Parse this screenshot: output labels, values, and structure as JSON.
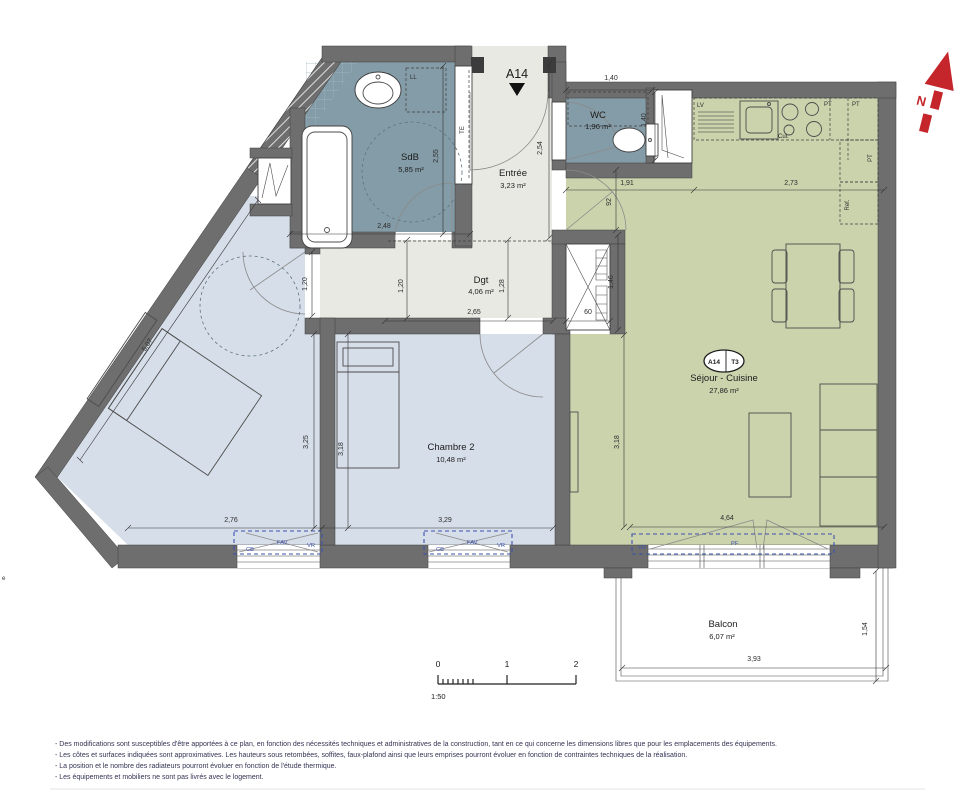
{
  "meta": {
    "unit": "A14",
    "north": "N",
    "edge_text": "e"
  },
  "badge": {
    "unit": "A14",
    "type": "T3"
  },
  "rooms": {
    "sdb": {
      "name": "SdB",
      "area": "5,85 m²"
    },
    "entree": {
      "name": "Entrée",
      "area": "3,23 m²"
    },
    "wc": {
      "name": "WC",
      "area": "1,96 m²"
    },
    "dgt": {
      "name": "Dgt",
      "area": "4,06 m²"
    },
    "chambre2": {
      "name": "Chambre 2",
      "area": "10,48 m²"
    },
    "sejour": {
      "name": "Séjour - Cuisine",
      "area": "27,86 m²"
    },
    "balcon": {
      "name": "Balcon",
      "area": "6,07 m²"
    }
  },
  "dims": {
    "wc_top": "1,40",
    "wc_right": "1,40",
    "sdb_right": "2,55",
    "sdb_bottom": "2,48",
    "entree_right": "2,54",
    "kitchen_left": "1,91",
    "kitchen_right": "2,73",
    "sejour_door": "92",
    "ch1_door": "1,20",
    "dgt_left": "1,20",
    "dgt_right": "1,28",
    "dgt_width": "2,65",
    "placard": "60",
    "placard_right": "1,46",
    "ch1_diag": "5,07",
    "ch1_right": "3,25",
    "ch2_left": "3,18",
    "sejour_left": "3,18",
    "ch1_bottom": "2,76",
    "ch2_bottom": "3,29",
    "sejour_bottom": "4,64",
    "balcon_bottom": "3,93",
    "balcon_right": "1,54"
  },
  "equipment": {
    "ll": "LL",
    "te": "TE",
    "lv": "LV",
    "cui": "Cui.",
    "pt_a": "PT",
    "pt_b": "PT",
    "pt_c": "PT",
    "ref": "Ref."
  },
  "windows": {
    "w1": {
      "l1": "CB",
      "l2": "FAV",
      "l3": "VR"
    },
    "w2": {
      "l1": "CB",
      "l2": "FAV",
      "l3": "VR"
    },
    "w3": {
      "l1": "VR",
      "l2": "PF"
    }
  },
  "scalebar": {
    "t0": "0",
    "t1": "1",
    "t2": "2",
    "ratio": "1:50"
  },
  "notes": {
    "l1": "- Des modifications sont susceptibles d'être apportées à ce plan, en fonction des nécessités techniques et administratives de la construction, tant en ce qui concerne les dimensions libres que pour les emplacements des équipements.",
    "l2": "- Les côtes et surfaces indiquées sont approximatives. Les hauteurs sous retombées, soffites, faux-plafond ainsi que leurs emprises pourront évoluer en fonction de contraintes techniques de la réalisation.",
    "l3": "- La position et le nombre des radiateurs pourront évoluer en fonction de l'étude thermique.",
    "l4": "- Les équipements et mobiliers ne sont pas livrés avec le logement."
  },
  "colors": {
    "wall": "#6e6e6e",
    "wet": "#849ca7",
    "bedroom": "#d6dee9",
    "living": "#cbd3ad",
    "hall": "#e9e9e4",
    "annotation_blue": "#3c50ae",
    "north_red": "#c4262c"
  }
}
